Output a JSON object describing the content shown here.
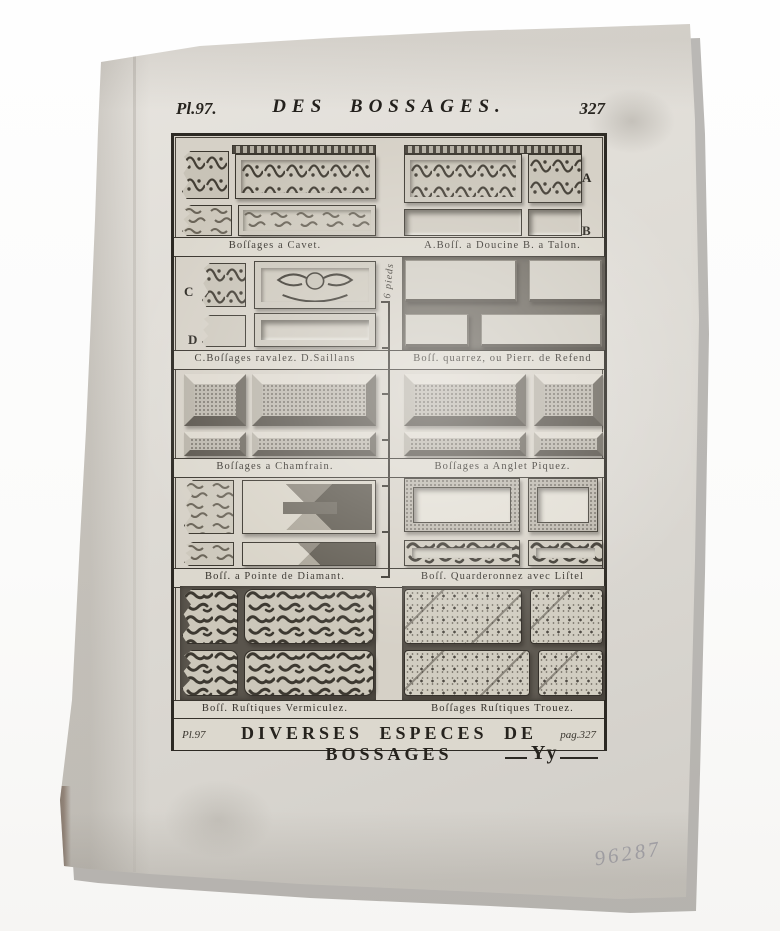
{
  "colors": {
    "paper": "#dcd8d0",
    "ink": "#2e2b26",
    "pencil": "#a5a4aa"
  },
  "header": {
    "plate": "Pl.97.",
    "title": "DES BOSSAGES.",
    "page": "327"
  },
  "figures": {
    "rows": [
      {
        "left": "Boſſages a Cavet.",
        "right": "A.Boſſ. a Doucine B. a Talon."
      },
      {
        "left": "C.Boſſages ravalez. D.Saillans",
        "right": "Boſſ. quarrez, ou Pierr. de Refend"
      },
      {
        "left": "Boſſages a Chamfrain.",
        "right": "Boſſages a Anglet Piquez."
      },
      {
        "left": "Boſſ. a Pointe de Diamant.",
        "right": "Boſſ. Quarderonnez avec Liſtel"
      },
      {
        "left": "Boſſ. Ruſtiques Vermiculez.",
        "right": "Boſſages Ruſtiques Trouez."
      }
    ],
    "letters": {
      "a": "A",
      "b": "B",
      "c": "C",
      "d": "D"
    },
    "scale_label": "6 pieds"
  },
  "footer": {
    "plate_ref": "Pl.97",
    "title": "DIVERSES ESPECES DE BOSSAGES",
    "page_ref": "pag.327",
    "signature": "Yy"
  },
  "annotations": {
    "pencil_number": "96287"
  }
}
